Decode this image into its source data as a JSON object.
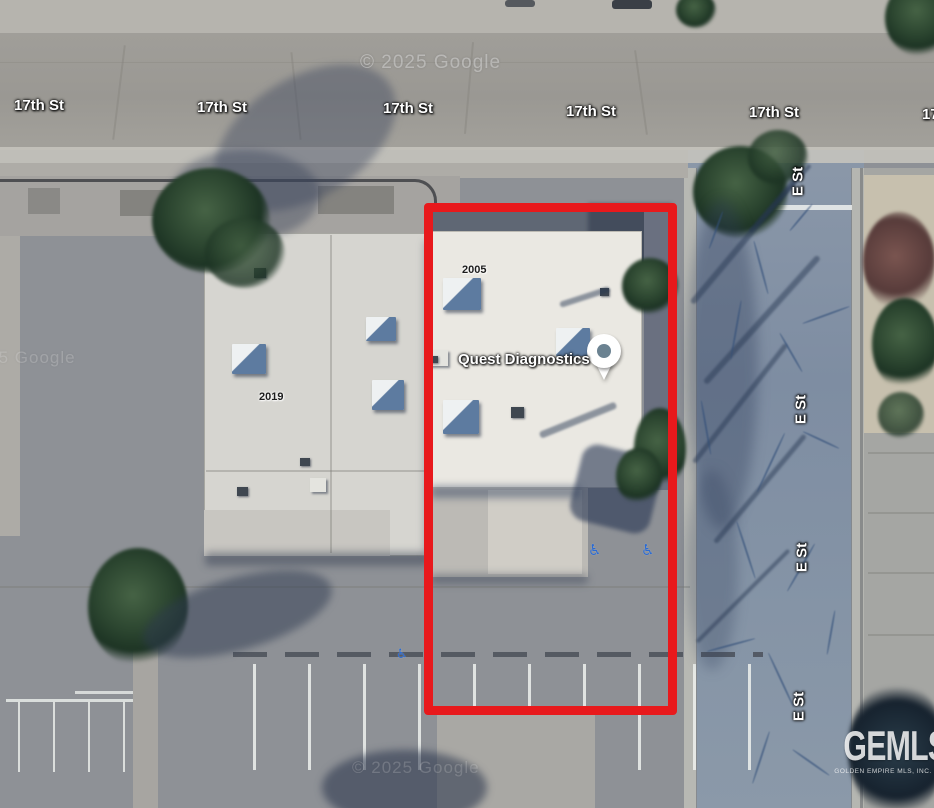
{
  "map": {
    "copyright": "© 2025 Google",
    "street_h_label": "17th St",
    "street_v_label": "E St",
    "place_label": "Quest Diagnostics",
    "parcel_2005": "2005",
    "parcel_2019": "2019",
    "accessible_symbol": "♿",
    "outline_color": "#e8191c",
    "pin_dot_color": "#6b8291",
    "accessible_color": "#2b6bd3",
    "logo": {
      "title": "GEMLS",
      "subtitle": "GOLDEN EMPIRE MLS, INC."
    }
  }
}
